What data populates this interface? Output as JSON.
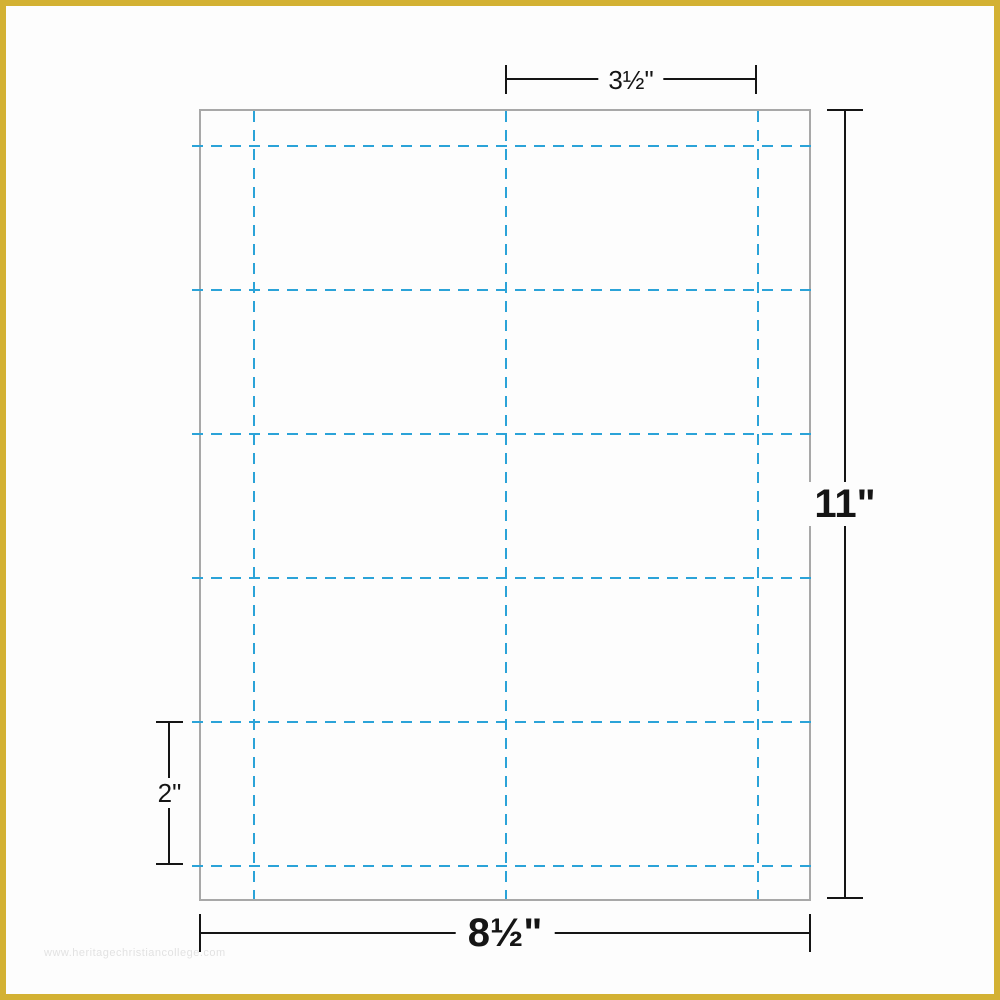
{
  "colors": {
    "frame_yellow": "#d3b133",
    "cut_line_blue": "#2ba3d8",
    "sheet_border_gray": "#a8a8a8",
    "dimension_text_black": "#151515",
    "watermark_gray": "#e2e2e2",
    "background_white": "#fdfdfd"
  },
  "sheet": {
    "vertical_cut_lines_x": [
      52,
      304,
      556
    ],
    "horizontal_cut_lines_y": [
      34,
      178,
      322,
      466,
      610,
      754
    ]
  },
  "dimensions": {
    "card_width_label": "3½\"",
    "sheet_height_label": "11\"",
    "card_height_label": "2\"",
    "sheet_width_label": "8½\""
  },
  "watermark": "www.heritagechristiancollege.com"
}
